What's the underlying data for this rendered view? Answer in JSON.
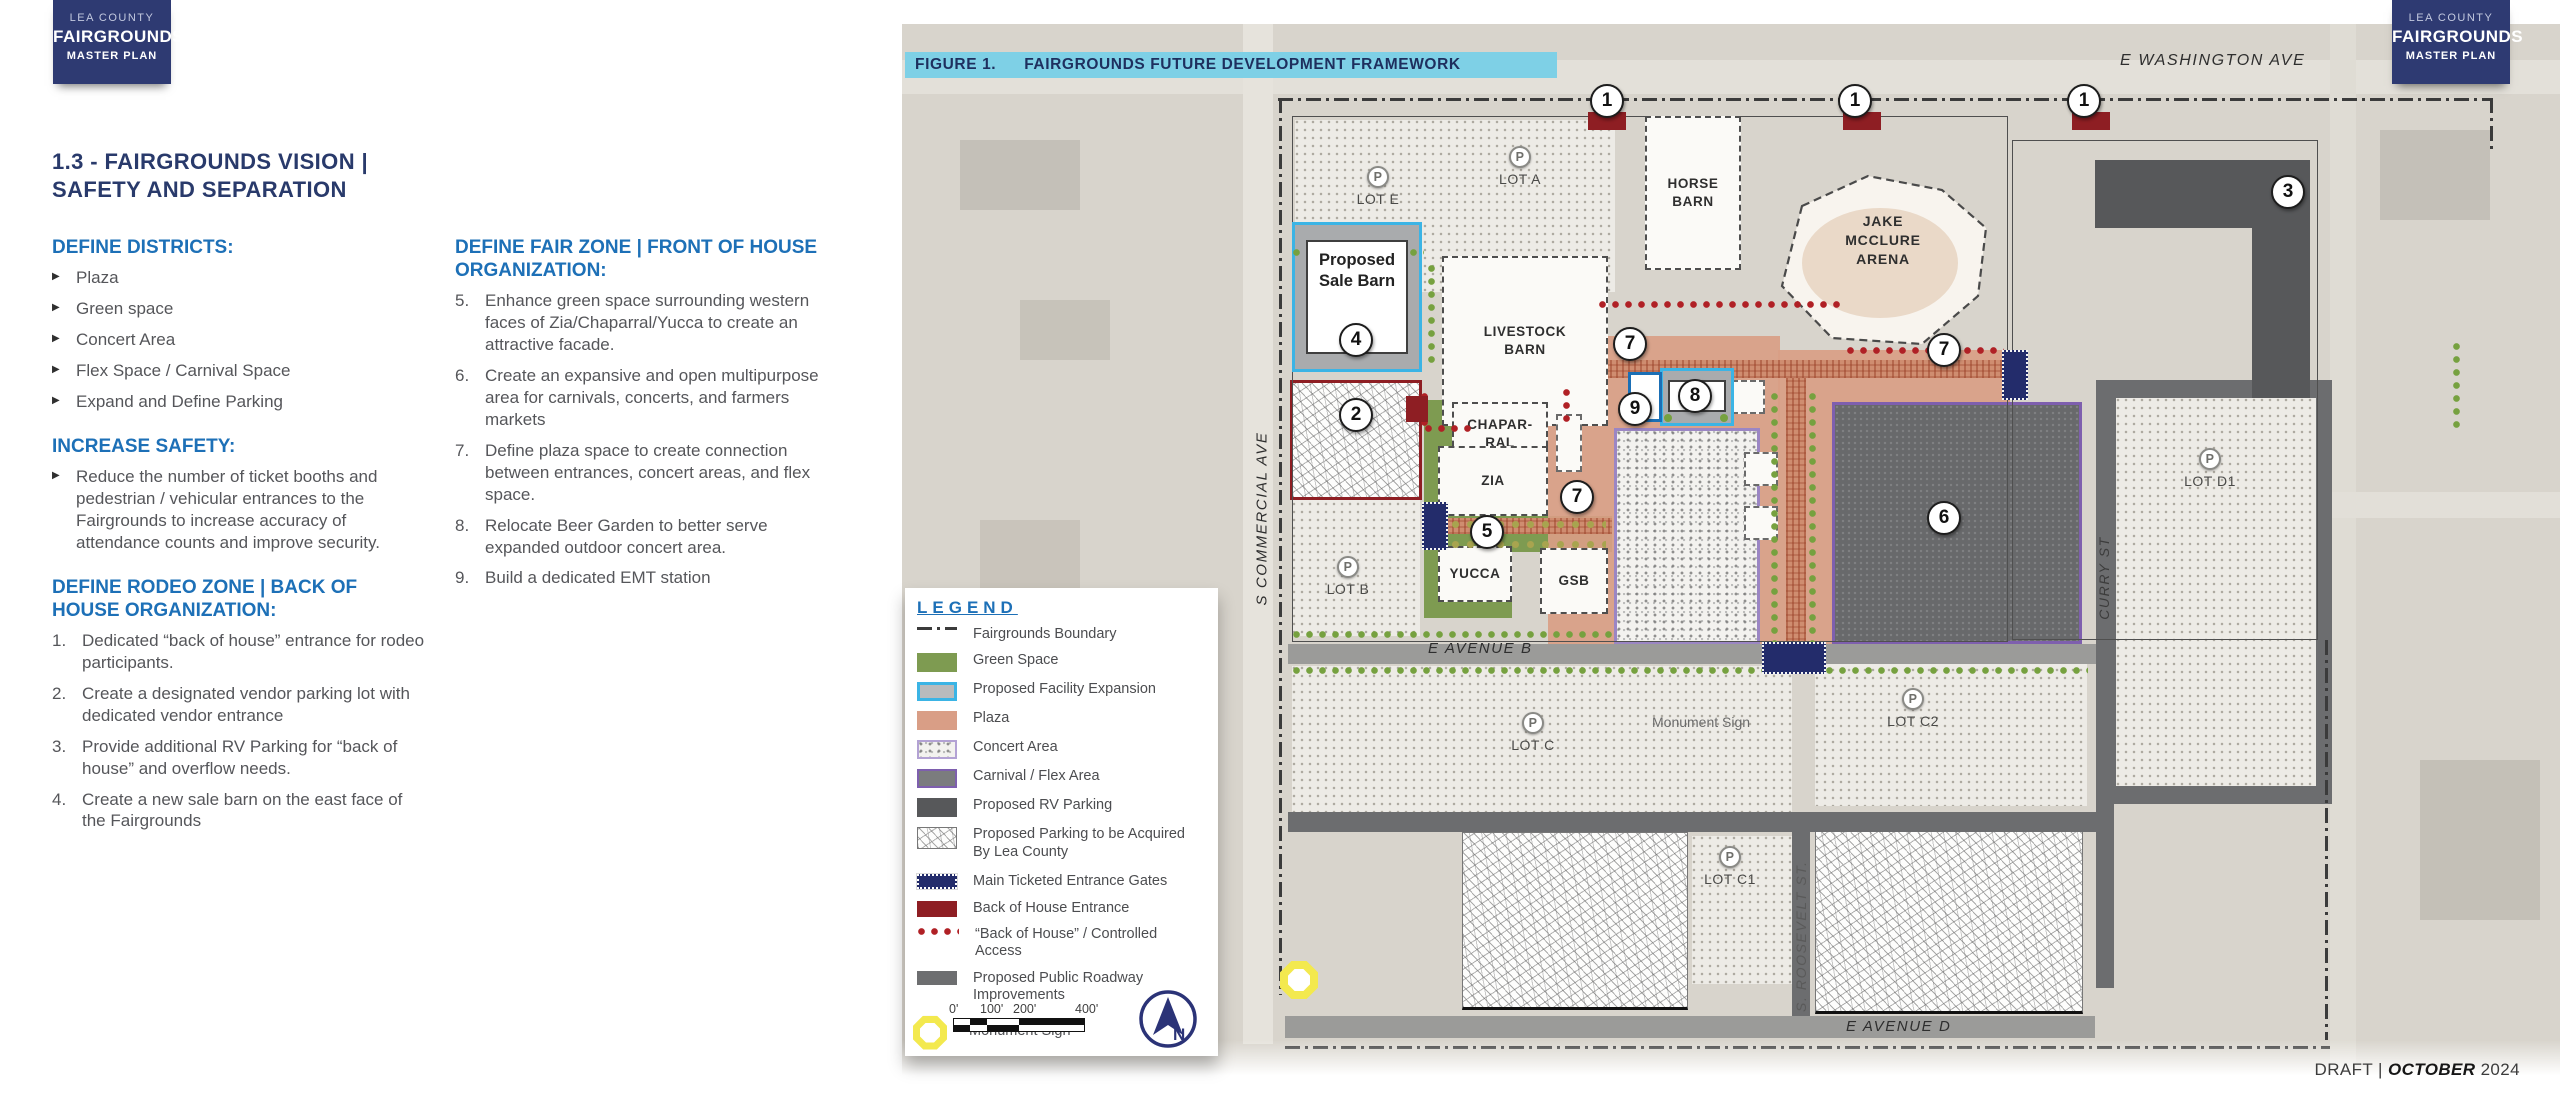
{
  "badge": {
    "county": "LEA COUNTY",
    "name": "FAIRGROUNDS",
    "plan": "MASTER PLAN"
  },
  "page": {
    "title_line1": "1.3 - FAIRGROUNDS VISION |",
    "title_line2": "SAFETY AND SEPARATION"
  },
  "columns": {
    "districts": {
      "heading": "DEFINE DISTRICTS:",
      "bullets": [
        "Plaza",
        "Green space",
        "Concert Area",
        "Flex Space / Carnival Space",
        "Expand and Define Parking"
      ]
    },
    "safety": {
      "heading": "INCREASE SAFETY:",
      "bullets": [
        "Reduce the number of ticket booths and pedestrian / vehicular entrances to the Fairgrounds to increase accuracy of attendance counts and improve security."
      ]
    },
    "rodeo": {
      "heading": "DEFINE RODEO ZONE | BACK OF HOUSE ORGANIZATION:",
      "items": [
        {
          "num": "1.",
          "text": "Dedicated “back of house” entrance for rodeo participants."
        },
        {
          "num": "2.",
          "text": "Create a designated vendor parking lot with dedicated vendor entrance"
        },
        {
          "num": "3.",
          "text": "Provide additional RV Parking for “back of house” and overflow needs."
        },
        {
          "num": "4.",
          "text": "Create a new sale barn on the east face of the Fairgrounds"
        }
      ]
    },
    "fair": {
      "heading": "DEFINE FAIR ZONE | FRONT OF HOUSE ORGANIZATION:",
      "items": [
        {
          "num": "5.",
          "text": "Enhance green space surrounding western faces of Zia/Chaparral/Yucca to create an attractive facade."
        },
        {
          "num": "6.",
          "text": "Create an expansive and open multipurpose area for carnivals, concerts, and farmers markets"
        },
        {
          "num": "7.",
          "text": "Define plaza space to create connection between entrances, concert areas, and flex space."
        },
        {
          "num": "8.",
          "text": "Relocate Beer Garden to better serve expanded outdoor concert area."
        },
        {
          "num": "9.",
          "text": "Build a dedicated EMT station"
        }
      ]
    }
  },
  "figure": {
    "label": "FIGURE 1.",
    "title": "FAIRGROUNDS FUTURE DEVELOPMENT FRAMEWORK"
  },
  "legend": {
    "title": "LEGEND",
    "items": [
      "Fairgrounds Boundary",
      "Green Space",
      "Proposed Facility Expansion",
      "Plaza",
      "Concert Area",
      "Carnival / Flex Area",
      "Proposed RV Parking",
      "Proposed Parking to be Acquired By Lea County",
      "Main Ticketed Entrance Gates",
      "Back of House Entrance",
      "“Back of House” / Controlled Access",
      "Proposed Public Roadway Improvements",
      "Monument Sign"
    ]
  },
  "scalebar": {
    "t0": "0'",
    "t100": "100'",
    "t200": "200'",
    "t400": "400'"
  },
  "north_letter": "N",
  "footer": {
    "draft": "DRAFT",
    "divider": "|",
    "month": "OCTOBER",
    "year": "2024"
  },
  "map": {
    "streets": {
      "washington": "E WASHINGTON AVE",
      "commercial": "S COMMERCIAL AVE",
      "curry": "CURRY ST",
      "roosevelt": "S. ROOSEVELT ST.",
      "avenue_b": "E AVENUE B",
      "avenue_d": "E AVENUE D"
    },
    "lots": {
      "p": "P",
      "e": "LOT E",
      "a": "LOT A",
      "b": "LOT B",
      "c": "LOT C",
      "c1": "LOT C1",
      "c2": "LOT C2",
      "d1": "LOT D1"
    },
    "buildings": {
      "horse": "HORSE BARN",
      "arena1": "JAKE",
      "arena2": "MCCLURE",
      "arena3": "ARENA",
      "sale1": "Proposed",
      "sale2": "Sale Barn",
      "livestock": "LIVESTOCK BARN",
      "chap1": "CHAPAR-",
      "chap2": "RAL",
      "zia": "ZIA",
      "yucca": "YUCCA",
      "gsb": "GSB"
    },
    "monument": "Monument Sign",
    "nums": {
      "n1": "1",
      "n2": "2",
      "n3": "3",
      "n4": "4",
      "n5": "5",
      "n6": "6",
      "n7": "7",
      "n8": "8",
      "n9": "9"
    }
  },
  "colors": {
    "navy": "#293a6b",
    "accent_blue": "#1d70b7",
    "cyan_bar": "#7ed0e6",
    "green": "#7e9b51",
    "plaza": "#d99e86",
    "purple": "#7e5fae",
    "dark_red": "#8e1e23",
    "red_dot": "#b02025",
    "gate_navy": "#232c6b",
    "rv_gray": "#57585a",
    "roadway_gray": "#6d6e70",
    "monument_yellow": "#f3e94e"
  }
}
